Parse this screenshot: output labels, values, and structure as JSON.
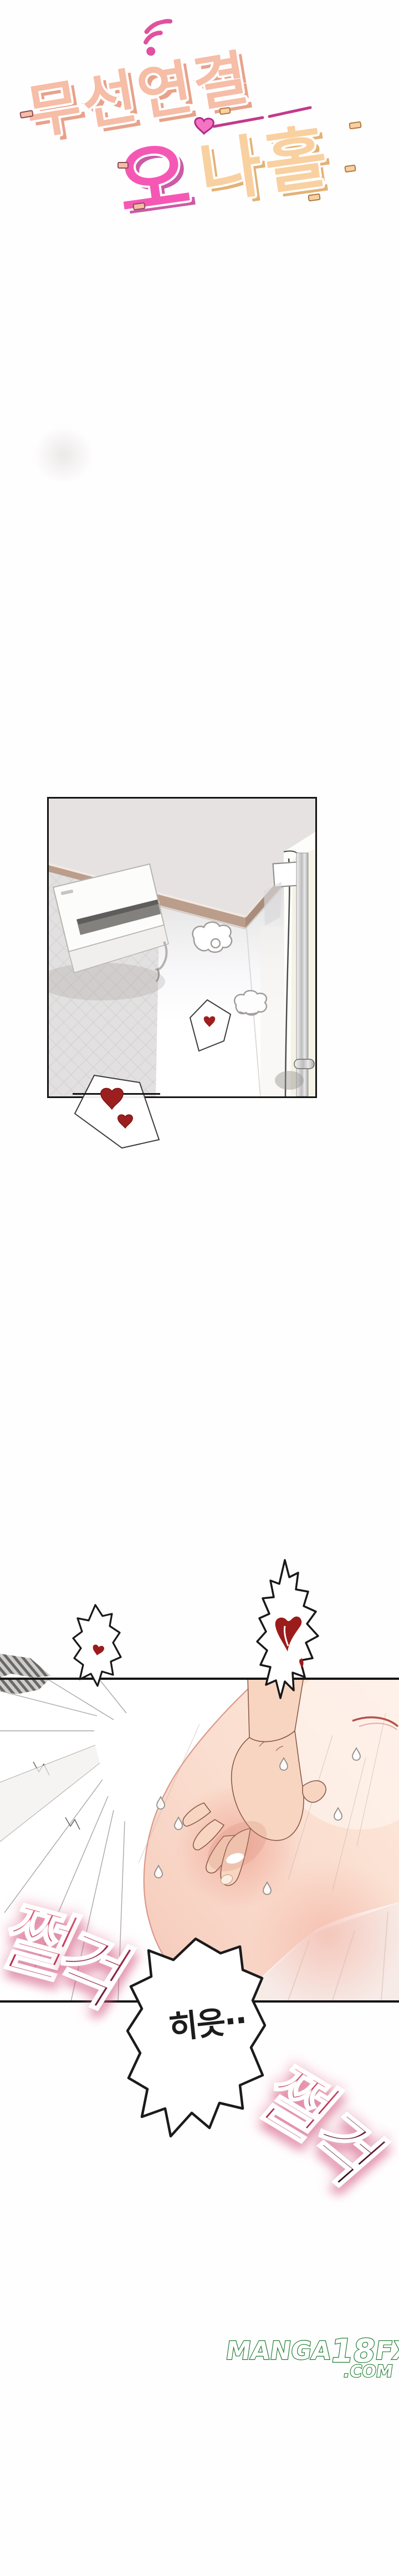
{
  "logo": {
    "title_line1": "무선연결",
    "title_line2_first": "오",
    "title_line2_rest": "나홀",
    "colors": {
      "line1_fill": "#f6bda7",
      "line1_outline": "#8d4b55",
      "line2_first_fill": "#f558b4",
      "line2_first_outline": "#a63181",
      "line2_rest_fill": "#f9d0a0",
      "line2_rest_outline": "#aa7a42",
      "wifi_icon": "#e0519e",
      "heart_line": "#c23a8c"
    }
  },
  "sfx_top": {
    "char1": "쩔",
    "char2": "걱",
    "color_top": "#e25a78",
    "color_bottom": "#5f132e"
  },
  "bubble": {
    "text": "히읏··"
  },
  "sfx_bottom": {
    "char1": "쩔",
    "char2": "걱",
    "color_top": "#d64e6c",
    "color_bottom": "#180408"
  },
  "hearts": {
    "color": "#9c1b1b"
  },
  "watermark": {
    "part1": "MANGA",
    "part2": "18",
    "part3": "FX",
    "line2": ".COM",
    "color": "#1f7d32"
  }
}
